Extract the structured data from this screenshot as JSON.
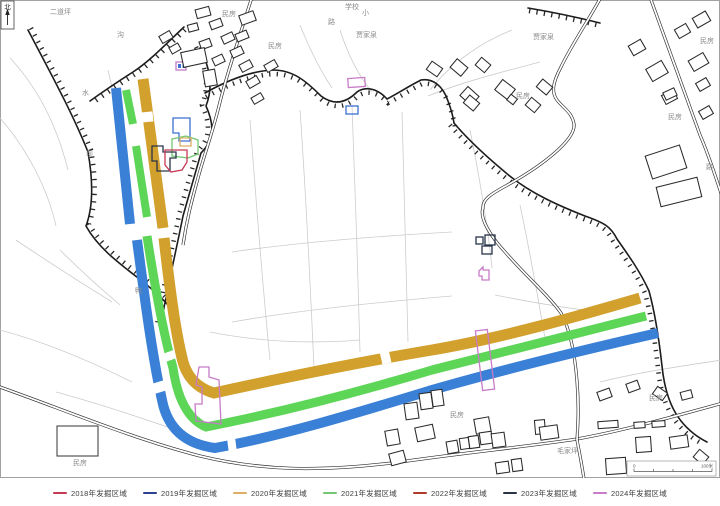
{
  "colors": {
    "band_gold": "#d2a02c",
    "band_green": "#5dd557",
    "band_blue": "#3a80d6",
    "outline_blue": "#3c6fd0",
    "y2018": "#c63955",
    "y2019": "#2e3f8f",
    "y2020": "#dcae62",
    "y2021": "#72c872",
    "y2022": "#b03a2a",
    "y2023": "#2a3448",
    "y2024": "#c77bc8"
  },
  "legend": {
    "items": [
      {
        "year": "2018",
        "label": "2018年发掘区域",
        "color": "#c63955"
      },
      {
        "year": "2019",
        "label": "2019年发掘区域",
        "color": "#2e3f8f"
      },
      {
        "year": "2020",
        "label": "2020年发掘区域",
        "color": "#dcae62"
      },
      {
        "year": "2021",
        "label": "2021年发掘区域",
        "color": "#72c872"
      },
      {
        "year": "2022",
        "label": "2022年发掘区域",
        "color": "#b03a2a"
      },
      {
        "year": "2023",
        "label": "2023年发掘区域",
        "color": "#2a3448"
      },
      {
        "year": "2024",
        "label": "2024年发掘区域",
        "color": "#c77bc8"
      }
    ]
  },
  "map": {
    "north_label": "北",
    "scale_bar": {
      "start": "0",
      "end": "100米"
    },
    "labels": [
      {
        "text": "二道坪",
        "x": 50,
        "y": 14,
        "s": 7
      },
      {
        "text": "民房",
        "x": 222,
        "y": 16,
        "s": 7
      },
      {
        "text": "民房",
        "x": 268,
        "y": 48,
        "s": 7
      },
      {
        "text": "学校",
        "x": 345,
        "y": 9,
        "s": 7
      },
      {
        "text": "小",
        "x": 362,
        "y": 15,
        "s": 6
      },
      {
        "text": "路",
        "x": 328,
        "y": 24,
        "s": 6
      },
      {
        "text": "贾家泉",
        "x": 356,
        "y": 37,
        "s": 7
      },
      {
        "text": "贾家泉",
        "x": 533,
        "y": 39,
        "s": 7
      },
      {
        "text": "民房",
        "x": 700,
        "y": 43,
        "s": 7
      },
      {
        "text": "民房",
        "x": 516,
        "y": 98,
        "s": 7
      },
      {
        "text": "民房",
        "x": 668,
        "y": 119,
        "s": 7
      },
      {
        "text": "沟",
        "x": 117,
        "y": 37,
        "s": 7
      },
      {
        "text": "水",
        "x": 82,
        "y": 95,
        "s": 7
      },
      {
        "text": "坝",
        "x": 86,
        "y": 156,
        "s": 7
      },
      {
        "text": "鸭",
        "x": 135,
        "y": 293,
        "s": 7
      },
      {
        "text": "路",
        "x": 706,
        "y": 169,
        "s": 6
      },
      {
        "text": "民房",
        "x": 450,
        "y": 417,
        "s": 7
      },
      {
        "text": "民房",
        "x": 649,
        "y": 400,
        "s": 7
      },
      {
        "text": "毛家坪",
        "x": 557,
        "y": 453,
        "s": 7
      },
      {
        "text": "民房",
        "x": 73,
        "y": 465,
        "s": 7
      }
    ]
  }
}
